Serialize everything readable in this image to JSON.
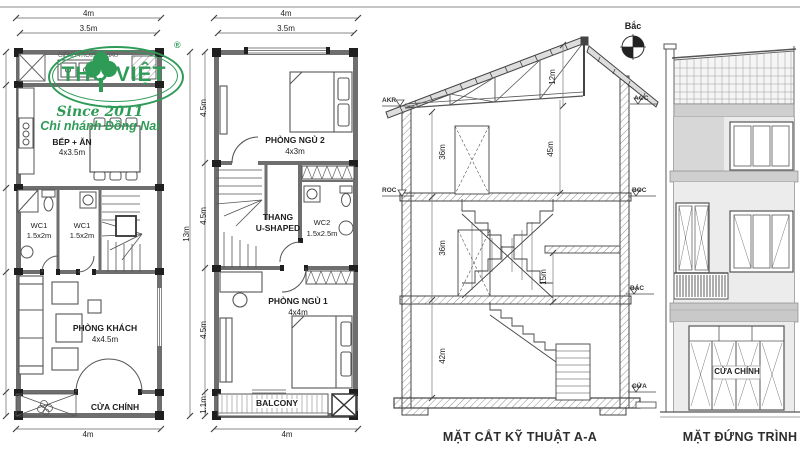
{
  "logo": {
    "brand": "THỌ VIỆT",
    "reg": "®",
    "since": "Since 2011",
    "branch": "Chi nhánh Đồng Nai"
  },
  "plan_ground": {
    "dim_top_outer": "4m",
    "dim_top_inner": "3.5m",
    "dim_bottom": "4m",
    "backyard_label": "GIẾNG TRỜI/SÂN SAU",
    "kitchen_name": "BẾP + ĂN",
    "kitchen_size": "4x3.5m",
    "wc_left_name": "WC1",
    "wc_left_size": "1.5x2m",
    "wc_right_name": "WC1",
    "wc_right_size": "1.5x2m",
    "living_name": "PHÒNG KHÁCH",
    "living_size": "4x4.5m",
    "main_door_label": "CỬA CHÍNH"
  },
  "plan_upper": {
    "dim_top_outer": "4m",
    "dim_top_inner": "3.5m",
    "dim_bottom": "4m",
    "dim_total": "13m",
    "dim_seg_1": "4.5m",
    "dim_seg_2": "4.5m",
    "dim_seg_3": "4.5m",
    "dim_seg_4": "1.1m",
    "bedroom2_name": "PHÒNG NGỦ 2",
    "bedroom2_size": "4x3m",
    "stair_line1": "THANG",
    "stair_line2": "U-SHAPED",
    "wc2_name": "WC2",
    "wc2_size": "1.5x2.5m",
    "bedroom1_name": "PHÒNG NGỦ 1",
    "bedroom1_size": "4x4m",
    "balcony_label": "BALCONY"
  },
  "section": {
    "title": "MẶT CẮT KỸ THUẬT A-A",
    "compass_label": "Bắc",
    "level_akr": "AKR",
    "level_roc": "ROC",
    "level_aoc": "AOC",
    "level_boc": "BOC",
    "level_bac": "BÁC",
    "level_cua": "CỬA",
    "dim_roof": "12m",
    "dim_attic_left": "36m",
    "dim_attic_right": "45m",
    "dim_floor2": "36m",
    "dim_landing": "15m",
    "dim_ground": "42m"
  },
  "elevation": {
    "title": "MẶT ĐỨNG TRÌNH",
    "main_door_label": "CỬA CHÍNH"
  },
  "colors": {
    "logo_green": "#2e9b57",
    "line": "#4a4a4a",
    "wall_gray": "#6e6e6e",
    "hatch_gray": "#909090",
    "band_gray": "#cfcfcf",
    "paper": "#ffffff"
  }
}
